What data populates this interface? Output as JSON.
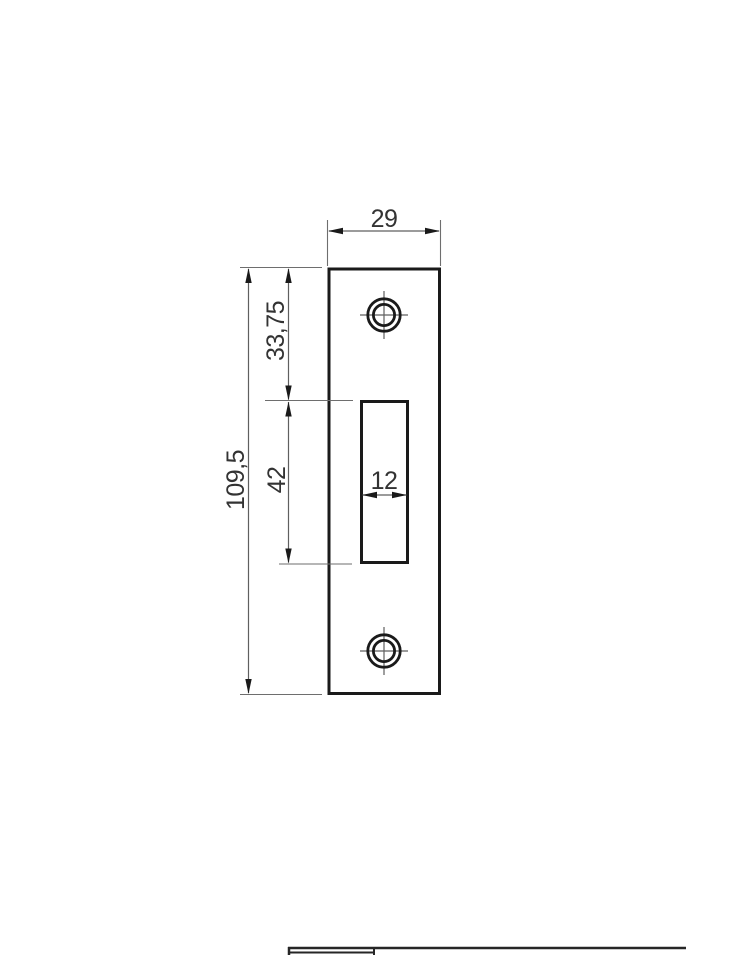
{
  "drawing": {
    "view": "strike-plate-front-view",
    "labels": {
      "plate_width": "29",
      "top_to_slot": "33,75",
      "slot_length": "42",
      "plate_length": "109,5",
      "slot_width": "12"
    },
    "colors": {
      "outline": "#1a1a1a",
      "dimension_lines": "#5f5f5f",
      "text": "#333333",
      "background": "#ffffff"
    }
  }
}
